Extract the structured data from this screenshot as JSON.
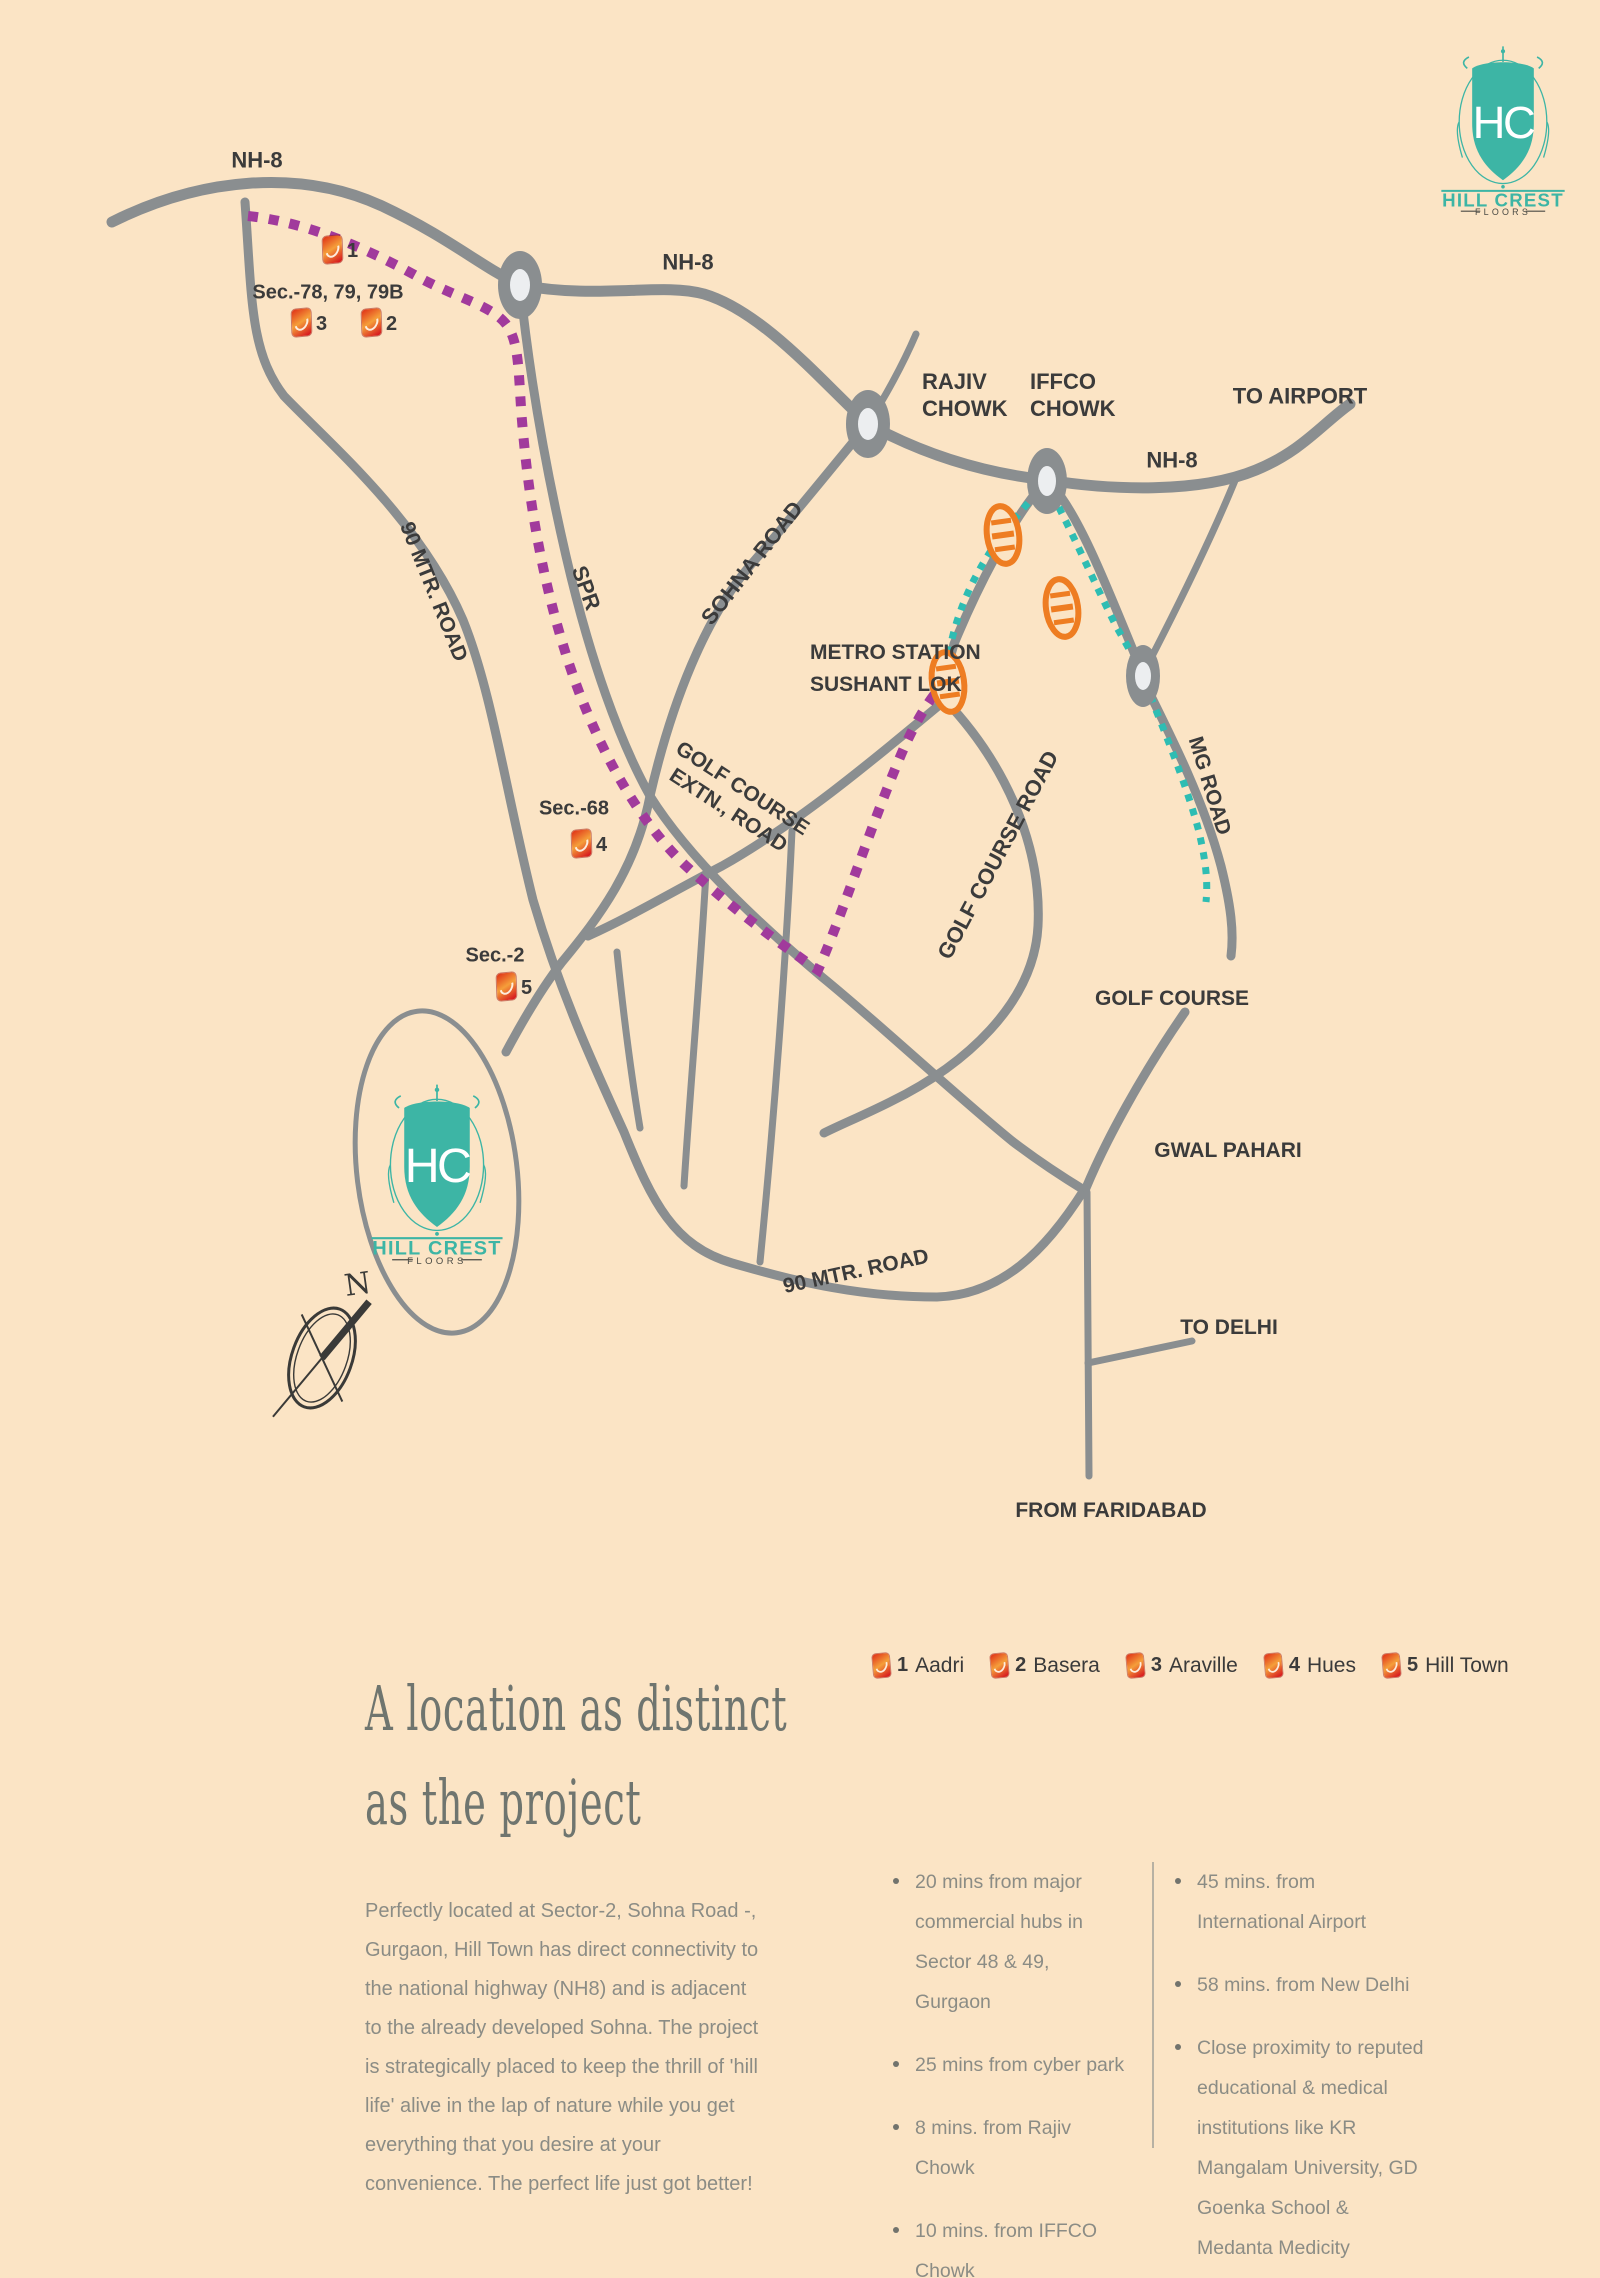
{
  "colors": {
    "bg": "#fbe4c5",
    "road": "#8a8e90",
    "purple": "#a13a9c",
    "metro": "#2ebdb3",
    "orange": "#ee7d22",
    "brand": "#3db5a5",
    "ink": "#3b3b3b",
    "body": "#8b8c85",
    "heading": "#6f756f"
  },
  "logo": {
    "monogram": "HC",
    "name": "HILL CREST",
    "sub": "FLOORS"
  },
  "map": {
    "labels": {
      "nh8_a": "NH-8",
      "nh8_b": "NH-8",
      "nh8_c": "NH-8",
      "rajiv_1": "RAJIV",
      "rajiv_2": "CHOWK",
      "iffco_1": "IFFCO",
      "iffco_2": "CHOWK",
      "to_airport": "TO AIRPORT",
      "metro_1": "METRO STATION",
      "metro_2": "SUSHANT LOK",
      "road90_a": "90 MTR. ROAD",
      "spr": "SPR",
      "sohna": "SOHNA ROAD",
      "gc_extn_1": "GOLF COURSE",
      "gc_extn_2": "EXTN., ROAD",
      "gc_road": "GOLF COURSE ROAD",
      "mg_road": "MG ROAD",
      "golf_course": "GOLF COURSE",
      "gwal_pahari": "GWAL PAHARI",
      "road90_b": "90 MTR. ROAD",
      "to_delhi": "TO DELHI",
      "from_faridabad": "FROM FARIDABAD",
      "sec78": "Sec.-78, 79, 79B",
      "sec68": "Sec.-68",
      "sec2": "Sec.-2",
      "compass_n": "N"
    },
    "markers": [
      {
        "num": "1"
      },
      {
        "num": "2"
      },
      {
        "num": "3"
      },
      {
        "num": "4"
      },
      {
        "num": "5"
      }
    ]
  },
  "legend": {
    "items": [
      {
        "num": "1",
        "name": "Aadri"
      },
      {
        "num": "2",
        "name": "Basera"
      },
      {
        "num": "3",
        "name": "Araville"
      },
      {
        "num": "4",
        "name": "Hues"
      },
      {
        "num": "5",
        "name": "Hill Town"
      }
    ]
  },
  "section": {
    "heading_line1": "A location as distinct",
    "heading_line2": "as the project",
    "intro": "Perfectly located at Sector-2,  Sohna Road -, Gurgaon, Hill Town has direct connectivity to the national highway (NH8) and is adjacent to the already developed Sohna. The project is strategically placed to keep the thrill of 'hill life' alive in the lap of nature while you get everything that you desire at your convenience. The perfect life just got better!",
    "bullets_col1": [
      "20 mins from major commercial hubs in Sector 48 & 49, Gurgaon",
      "25 mins from cyber park",
      "8 mins. from Rajiv Chowk",
      "10 mins. from IFFCO Chowk"
    ],
    "bullets_col2": [
      "45 mins. from International Airport",
      "58 mins. from New Delhi",
      "Close proximity to reputed educational  & medical institutions like KR Mangalam  University, GD Goenka School & Medanta Medicity"
    ]
  }
}
